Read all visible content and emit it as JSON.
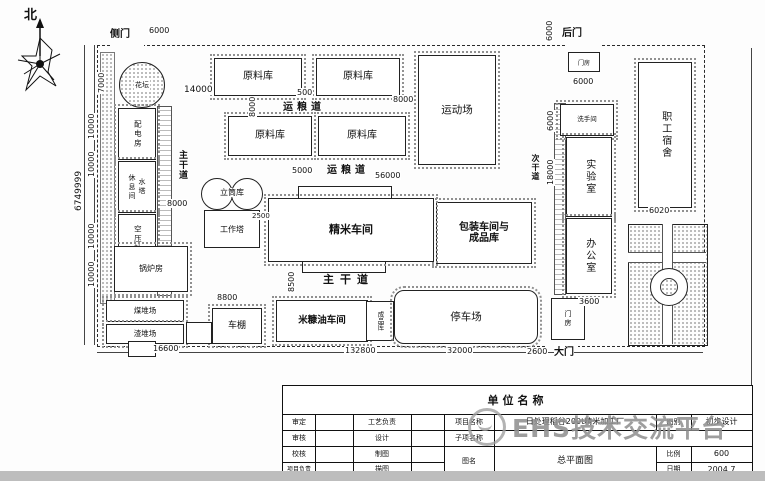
{
  "north": "北",
  "gates": {
    "side": "侧门",
    "back": "后门",
    "main": "大门"
  },
  "roads": {
    "grain": "运粮道",
    "main": "主干道",
    "secondary": "次干道"
  },
  "buildings": {
    "raw_warehouse": "原料库",
    "sports_ground": "运动场",
    "flower_bed": "花坛",
    "power_room": "配电房",
    "water_tower": "水塔",
    "rest_room": "休息间",
    "air_compressor": "空压站",
    "boiler_room": "锅炉房",
    "coal_yard": "煤堆场",
    "slag_yard": "渣堆场",
    "silo": "立筒库",
    "work_tower": "工作塔",
    "milling": "精米车间",
    "packing": "包装车间与\n成品库",
    "washroom": "洗手间",
    "lab": "实验室",
    "office": "办公室",
    "dorm": "职工宿舍",
    "bran_oil": "米糠油车间",
    "finished_store": "成品库",
    "bike_shed": "车棚",
    "parking": "停车场",
    "gatehouse": "门房"
  },
  "dims": {
    "d500": "500",
    "d2500": "2500",
    "d2600": "2600",
    "d3600": "3600",
    "d5000": "5000",
    "d6000": "6000",
    "d6020": "6020",
    "d7000": "7000",
    "d8000": "8000",
    "d8500": "8500",
    "d8800": "8800",
    "d10000": "10000",
    "d14000": "14000",
    "d16600": "16600",
    "d18000": "18000",
    "d32000": "32000",
    "d56000": "56000",
    "d132800": "132800",
    "d_total": "6749999"
  },
  "titleblock": {
    "company": "单位名称",
    "approve": "审定",
    "review": "审核",
    "check": "校核",
    "project_lead": "项目负责",
    "process_lead": "工艺负责",
    "design": "设计",
    "draft": "制图",
    "trace": "描图",
    "project_label": "项目名称",
    "project_value": "日处理稻谷200t精米加工厂",
    "stage_label": "图别",
    "stage_value": "初步设计",
    "subitem_label": "子项名称",
    "drawing_label": "图名",
    "drawing_value": "总平面图",
    "scale_label": "比例",
    "scale_value": "600",
    "date_label": "日期",
    "date_value": "2004.7"
  },
  "watermark": "EHS技术交流平台"
}
